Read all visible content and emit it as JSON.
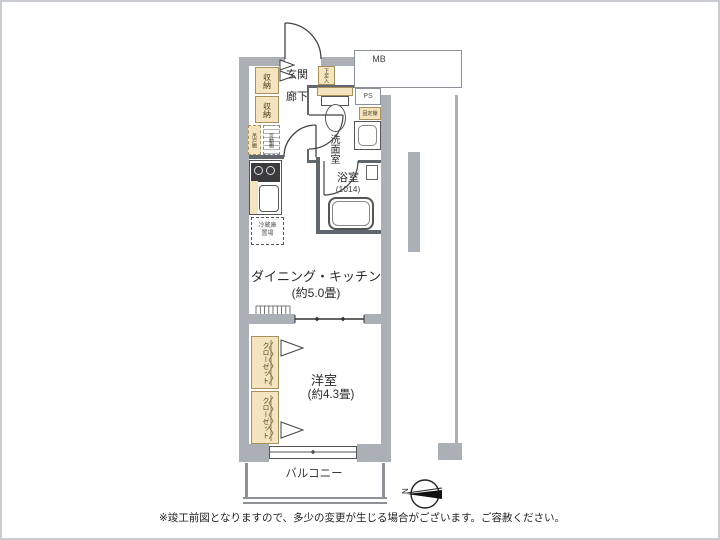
{
  "colors": {
    "wall": "#aab0b6",
    "storage_fill": "#f4e4c0",
    "storage_border": "#a8905c",
    "line": "#555555"
  },
  "entrance": {
    "genkan": "玄関",
    "rouka": "廊下",
    "shoes": "下足入",
    "storage": "収納"
  },
  "utility": {
    "mb": "MB",
    "ps": "PS",
    "fixed_shelf": "固定棚",
    "hanging_cabinet": "吊戸棚",
    "movable_shelf": "可動棚"
  },
  "washroom": {
    "name": "洗面室"
  },
  "bathroom": {
    "name": "浴室",
    "size": "(1014)"
  },
  "kitchen": {
    "name": "ダイニング・キッチン",
    "size": "(約5.0畳)",
    "fridge_line1": "冷蔵庫",
    "fridge_line2": "置場"
  },
  "bedroom": {
    "name": "洋室",
    "size": "(約4.3畳)",
    "closet": "クローゼット"
  },
  "balcony": {
    "name": "バルコニー"
  },
  "compass": {
    "north": "N"
  },
  "footer": {
    "note": "※竣工前図となりますので、多少の変更が生じる場合がございます。ご容赦ください。"
  }
}
